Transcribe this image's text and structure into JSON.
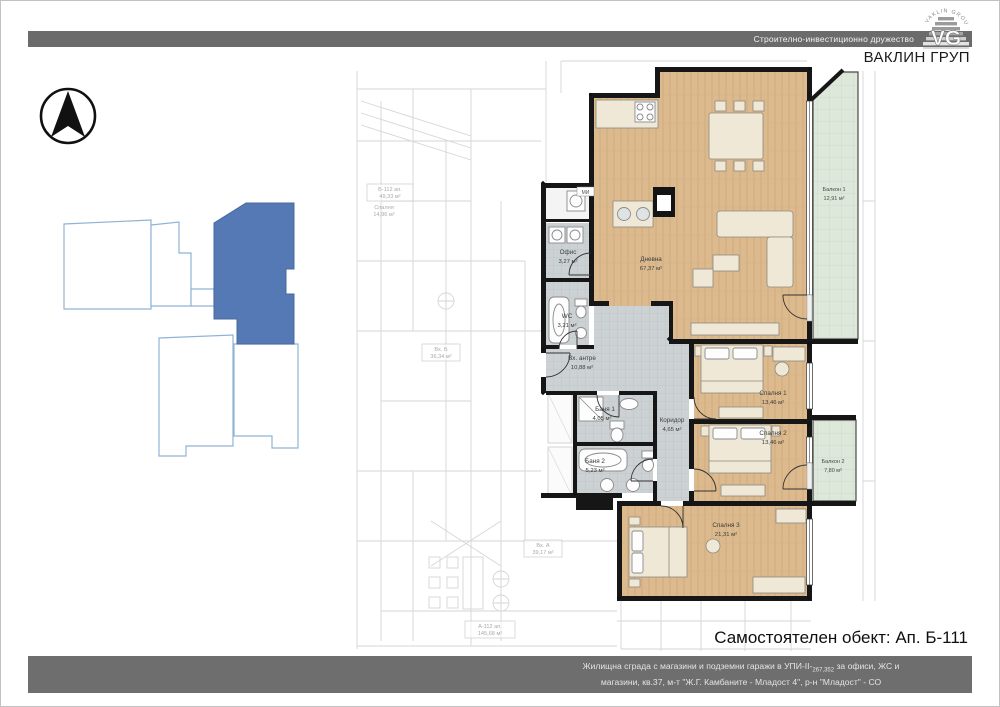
{
  "header": {
    "tagline": "Строително-инвестиционно дружество",
    "company": "ВАКЛИН ГРУП",
    "logo_arc": "VAKLIN GROUP",
    "logo_monogram": "VG"
  },
  "plan": {
    "rooms": [
      {
        "name": "Дневна",
        "area": "67,37 м²"
      },
      {
        "name": "Спалня 1",
        "area": "13,46 м²"
      },
      {
        "name": "Спалня 2",
        "area": "13,46 м²"
      },
      {
        "name": "Спалня 3",
        "area": "21,31 м²"
      },
      {
        "name": "Балкон 1",
        "area": "12,91 м²"
      },
      {
        "name": "Балкон 2",
        "area": "7,80 м²"
      },
      {
        "name": "Вх. антре",
        "area": "10,88 м²"
      },
      {
        "name": "Коридор",
        "area": "4,65 м²"
      },
      {
        "name": "Баня 1",
        "area": "4,05 м²"
      },
      {
        "name": "Баня 2",
        "area": "5,23 м²"
      },
      {
        "name": "WC",
        "area": "3,21 м²"
      },
      {
        "name": "Офис",
        "area": "3,27 м²"
      }
    ],
    "appliance_tag": "МИ",
    "bg_labels": [
      {
        "name": "Б-112 ап.",
        "area": "49,33 м²"
      },
      {
        "name": "Спалня",
        "area": "14,96 м²"
      },
      {
        "name": "Вх. Б",
        "area": "36,34 м²"
      },
      {
        "name": "Вх. А",
        "area": "39,17 м²"
      },
      {
        "name": "А-112 ап.",
        "area": "145,68 м²"
      }
    ]
  },
  "footer": {
    "object_label": "Самостоятелен обект: Ап. Б-111",
    "line1_pre": "Жилищна сграда с магазини и подземни гаражи в УПИ-II-",
    "line1_sub": "267,352",
    "line1_post": " за офиси, ЖС и",
    "line2": "магазини, кв.37, м-т \"Ж.Г. Камбаните - Младост 4\", р-н \"Младост\" - СО"
  },
  "colors": {
    "bar_gray": "#6b6b6b",
    "highlight_blue": "#5579b5",
    "wood_floor": "#dcba8e",
    "tile_gray": "#ccd2d4",
    "balcony_green": "#dde7da"
  }
}
